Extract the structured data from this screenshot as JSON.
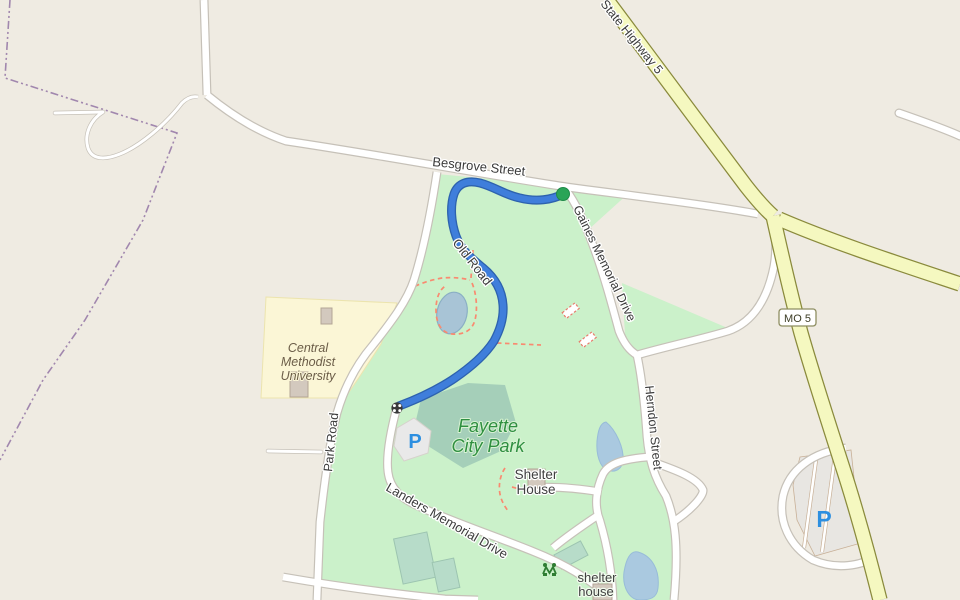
{
  "map": {
    "type": "openstreetmap-style slippy map tile view",
    "labels": {
      "state_highway": "State Highway 5",
      "besgrove": "Besgrove Street",
      "gaines": "Gaines Memorial Drive",
      "herndon": "Herndon Street",
      "old_road": "Old Road",
      "park_road": "Park Road",
      "landers": "Landers Memorial Drive",
      "mo5_badge": "MO 5",
      "university": {
        "line1": "Central",
        "line2": "Methodist",
        "line3": "University"
      },
      "park_name": {
        "line1": "Fayette",
        "line2": "City Park"
      },
      "shelter_house_poi": {
        "line1": "Shelter",
        "line2": "House"
      },
      "shelter_house_small": {
        "line1": "shelter",
        "line2": "house"
      },
      "parking_symbol": "P"
    },
    "route": {
      "start_marker": "green-dot",
      "end_marker": "gate",
      "color": "#3f7edb"
    },
    "colors": {
      "background": "#efebe2",
      "park_green": "#cbf1ca",
      "scrub_green": "#a5cfb9",
      "water": "#aac9e0",
      "highway_yellow": "#f5f8c0",
      "road_white": "#ffffff",
      "road_casing": "#c6c1b8",
      "route_blue": "#3f7edb",
      "route_start_green": "#2aa457",
      "university_yellow": "#fbf6d6",
      "boundary_purple": "#a187ae",
      "footpath_red": "#f98a70",
      "parking_blue": "#2d8fe0"
    }
  }
}
